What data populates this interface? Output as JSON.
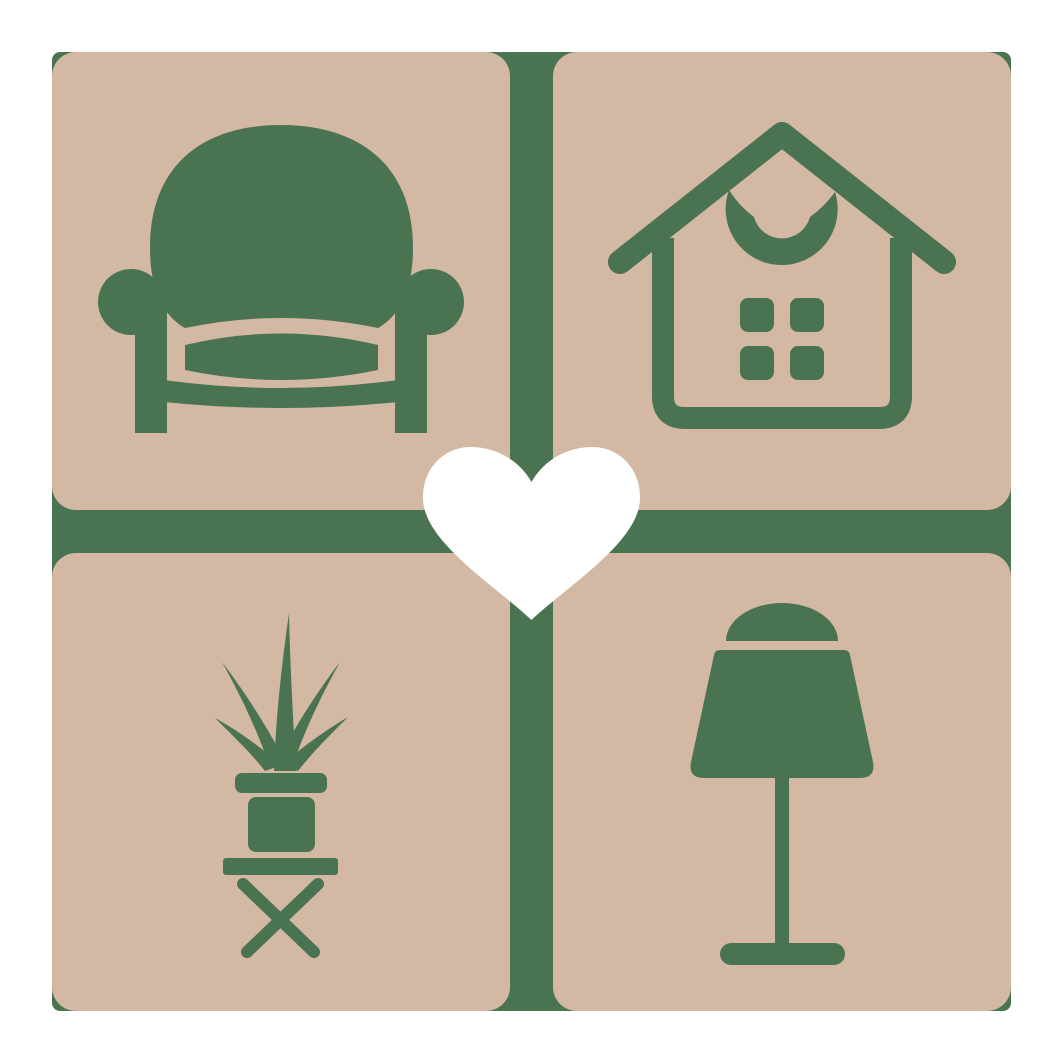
{
  "logo": {
    "background_color": "#ffffff",
    "tile_color": "#d3b9a3",
    "accent_color": "#4a7352",
    "heart_color": "#ffffff",
    "tiles": [
      {
        "position": "top-left",
        "icon": "armchair-icon"
      },
      {
        "position": "top-right",
        "icon": "house-icon"
      },
      {
        "position": "bottom-left",
        "icon": "potted-plant-on-stool-icon"
      },
      {
        "position": "bottom-right",
        "icon": "table-lamp-icon"
      }
    ],
    "center_icon": "heart-icon"
  }
}
